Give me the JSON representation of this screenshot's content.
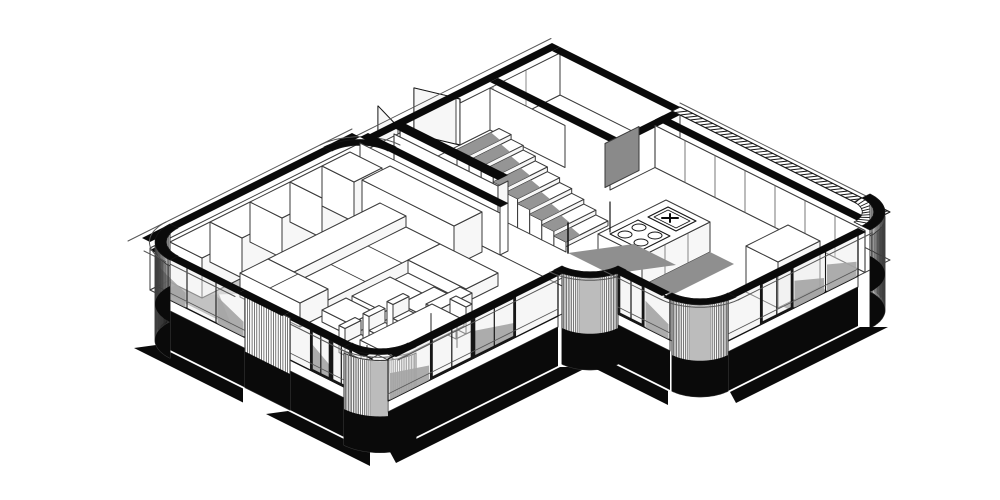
{
  "figure": {
    "title": "Axonometric cutaway floor plan",
    "description": "Black-and-white axonometric cutaway drawing of a single-storey residence: a living room with modular sofa, coffee table and dining table with chairs, a central staircase beside a tall guard wall, an entry with two open double-door leaves, a small bathroom with an open grey door, and a kitchen with an island (cooktop and sink), tall cabinet and wardrobe wall. The facade has curved ribbed corners, floor-to-ceiling glazing with dark mullions, solid black cut-wall tops, a hatched parapet over the rear wall and heavy black shadows below the glass line."
  },
  "palette": {
    "background": "#ffffff",
    "line": "#3a3a3a",
    "thin": "#565656",
    "dark": "#161616",
    "black": "#0a0a0a",
    "shadow": "#8f8f8f",
    "softShadow": "#b9b9b9",
    "paneShade": "#a4a4a4",
    "glass": "rgba(236,236,236,0.45)",
    "doorLeaf": "#8a8a8a",
    "white": "#ffffff",
    "faceTint": "#f7f7f7",
    "rib": "#3f3f3f"
  },
  "scene": {
    "stairs": {
      "steps": 9
    },
    "island": {
      "burners": 4,
      "hasSink": true
    },
    "wardrobe": {
      "doors": 5
    },
    "closetWall": {
      "panels": 7
    },
    "entry": {
      "leaves": 2
    },
    "dining": {
      "sideChairs": 3,
      "headChairs": 1
    },
    "glazing": {
      "frontLeftA": {
        "panes": 3,
        "doors": [],
        "shaded": [
          0,
          2
        ]
      },
      "frontLeftB": {
        "panes": 4,
        "doors": [
          1,
          2
        ],
        "shaded": [
          1,
          3
        ]
      },
      "frontRightA": {
        "panes": 4,
        "doors": [
          1,
          2
        ],
        "shaded": [
          0,
          2
        ]
      },
      "connector": {
        "panes": 2,
        "doors": [
          0
        ],
        "shaded": [
          1
        ]
      },
      "kitchenFront": {
        "panes": 4,
        "doors": [
          1
        ],
        "shaded": [
          2,
          3
        ]
      }
    }
  }
}
